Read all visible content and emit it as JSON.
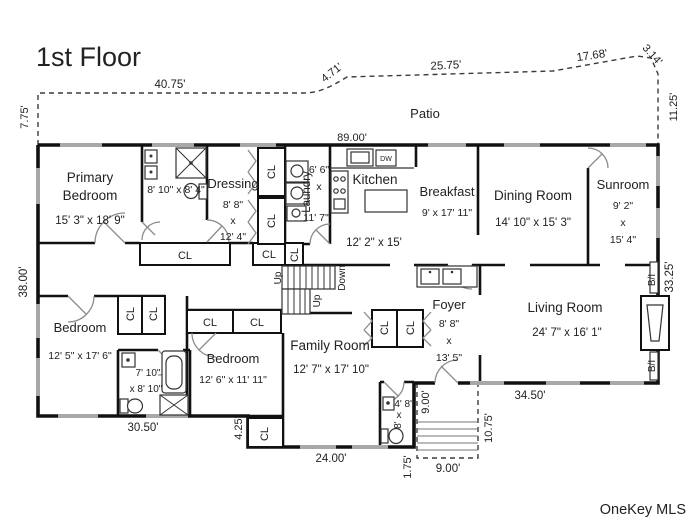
{
  "title": "1st Floor",
  "watermark": "OneKey MLS",
  "labels": {
    "patio": "Patio",
    "closet": "CL",
    "up": "Up",
    "down": "Down",
    "built_in": "B/I",
    "dishwasher": "DW"
  },
  "rooms": {
    "primary_bedroom": {
      "line1": "Primary",
      "line2": "Bedroom",
      "dims": "15' 3\" x 18' 9\""
    },
    "primary_bath": {
      "dims": "8' 10\" x 8' 4\""
    },
    "dressing": {
      "name": "Dressing",
      "d1": "8' 8\"",
      "d2": "x",
      "d3": "12' 4\""
    },
    "laundry": {
      "name": "Laundry",
      "d1": "6' 6\"",
      "d2": "x",
      "d3": "11' 7\""
    },
    "kitchen": {
      "name": "Kitchen",
      "dims": "12' 2\" x 15'"
    },
    "breakfast": {
      "name": "Breakfast",
      "dims": "9' x 17' 11\""
    },
    "dining_room": {
      "name": "Dining Room",
      "dims": "14' 10\" x 15' 3\""
    },
    "sunroom": {
      "name": "Sunroom",
      "d1": "9' 2\"",
      "d2": "x",
      "d3": "15' 4\""
    },
    "foyer": {
      "name": "Foyer",
      "d1": "8' 8\"",
      "d2": "x",
      "d3": "13' 5\""
    },
    "living_room": {
      "name": "Living Room",
      "dims": "24' 7\" x 16' 1\""
    },
    "family_room": {
      "name": "Family Room",
      "dims": "12' 7\" x 17' 10\""
    },
    "bedroom_left": {
      "name": "Bedroom",
      "dims": "12' 5\" x 17' 6\""
    },
    "bedroom_mid": {
      "name": "Bedroom",
      "dims": "12' 6\" x 11' 11\""
    },
    "hall_bath": {
      "d1": "7' 10\"",
      "d2": "x 8' 10\""
    },
    "powder_room": {
      "d1": "4' 8\"",
      "d2": "x",
      "d3": "8'"
    }
  },
  "dimensions": {
    "patio_left_height": "7.75'",
    "patio_top_1": "40.75'",
    "patio_top_2": "4.71'",
    "patio_top_3": "25.75'",
    "patio_top_4": "17.68'",
    "patio_top_5": "3.14'",
    "patio_right_height": "11.25'",
    "house_top": "89.00'",
    "house_left": "38.00'",
    "house_right": "33.25'",
    "bottom_left": "30.50'",
    "bottom_step": "4.25'",
    "bottom_mid": "24.00'",
    "entry_offset": "1.75'",
    "porch_side": "9.00'",
    "porch_height": "10.75'",
    "porch_width": "9.00'",
    "bottom_right": "34.50'"
  },
  "colors": {
    "wall": "#111111",
    "window": "#a8a8a8",
    "door": "#8c8c8c",
    "text": "#222222",
    "watermark": "#bcbcbc",
    "background": "#ffffff"
  }
}
